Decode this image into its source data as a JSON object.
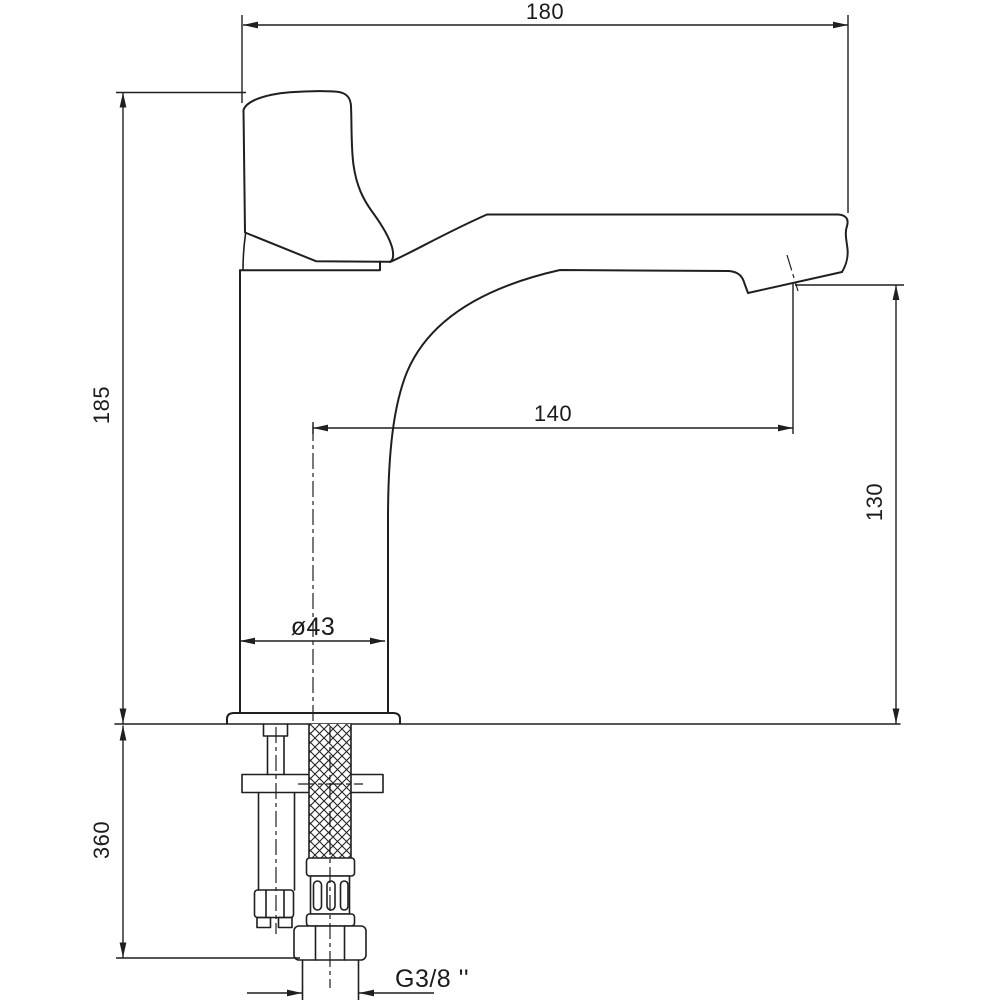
{
  "drawing": {
    "title": "Basin mixer faucet dimensional drawing",
    "dimensions": {
      "overall_width": "180",
      "body_height": "185",
      "spout_reach": "140",
      "spout_height": "130",
      "base_diameter": "ø43",
      "below_deck_length": "360",
      "thread_size": "G3/8 ''"
    },
    "colors": {
      "line": "#1f1f1f",
      "background": "#ffffff"
    }
  }
}
